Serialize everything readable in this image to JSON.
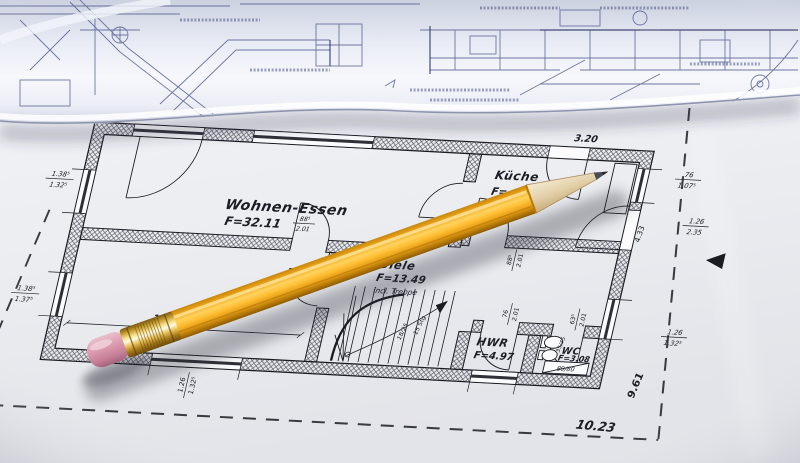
{
  "scene": {
    "type": "photograph",
    "description": "Rolled-up construction blueprint lying above a printed house floor plan, with a sharpened yellow pencil resting diagonally across the sheet"
  },
  "palette": {
    "paper": "#eef0f4",
    "blueprint_ink": "#4d588c",
    "plan_ink": "#1b1c22",
    "pencil_yellow": "#ffc23a",
    "pencil_ferrule_gold": "#e3b84a",
    "pencil_eraser_pink": "#d793a8",
    "pencil_wood": "#e6d5b2",
    "pencil_graphite": "#46464c"
  },
  "rooms": [
    {
      "name": "Wohnen-Essen",
      "area": "F=32.11"
    },
    {
      "name": "Küche",
      "area": "F="
    },
    {
      "name": "Diele",
      "area": "F=13.49",
      "note": "incl. Treppe"
    },
    {
      "name": "HWR",
      "area": "F=4.97"
    },
    {
      "name": "WC",
      "area": "F=3.08"
    }
  ],
  "dims": {
    "topRight": "3.20",
    "rightUpper": {
      "top": "76",
      "bottom": "1.07⁵"
    },
    "rightMid": {
      "top": "1.26",
      "bottom": "2.35"
    },
    "kuecheWall": "4.33",
    "rightLower": {
      "top": "1.26",
      "bottom": "1.32⁵"
    },
    "leftUpper": {
      "top": "1.38⁵",
      "bottom": "1.32⁵"
    },
    "leftLower": {
      "top": "1.38⁵",
      "bottom": "1.37⁵"
    },
    "bottomWindow": {
      "top": "1.26",
      "bottom": "1.32⁵"
    },
    "innerWidth": "13.33",
    "doorWohnen": {
      "top": "88⁵",
      "bottom": "2.01"
    },
    "doorDiele": {
      "top": "88⁵",
      "bottom": "2.01"
    },
    "doorKueche": {
      "top": "88⁵",
      "bottom": "2.01"
    },
    "doorHwr": {
      "top": "76",
      "bottom": "2.01"
    },
    "doorWc": {
      "top": "63⁵",
      "bottom": "2.01"
    },
    "basin": "35/45",
    "shower": "80/80",
    "stairStep": "18/25",
    "stairCount": "15 Stg",
    "depthRight": "9.61",
    "widthBottom": "10.23"
  }
}
